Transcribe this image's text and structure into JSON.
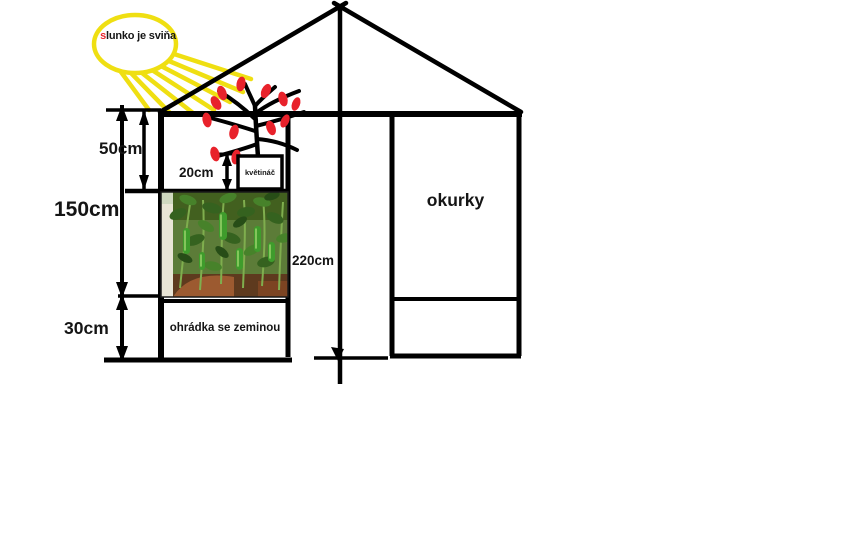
{
  "sun": {
    "label_first": "s",
    "label_rest": "lunko je sviňa"
  },
  "dimensions": {
    "top_section": "50cm",
    "pot_height": "20cm",
    "middle_section": "150cm",
    "bottom_section": "30cm",
    "total_height": "220cm"
  },
  "labels": {
    "pot_box": "květináč",
    "soil_box": "ohrádka se zeminou",
    "right_bed": "okurky"
  },
  "colors": {
    "line_black": "#000000",
    "sun_yellow": "#efdf12",
    "fruit_red": "#e8222b",
    "letter_red": "#e8262e",
    "photo_green": "#5c7c38"
  }
}
